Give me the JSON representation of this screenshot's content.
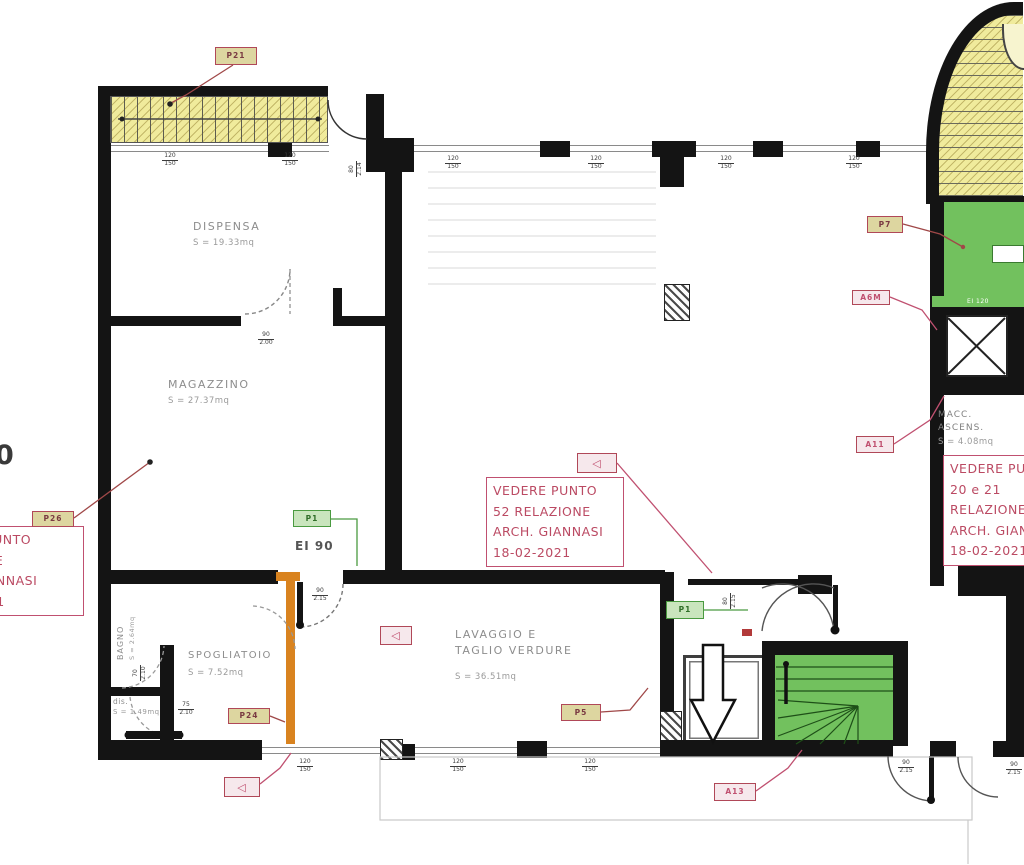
{
  "plan": {
    "rooms": {
      "dispensa": {
        "name": "DISPENSA",
        "area": "S = 19.33mq"
      },
      "magazzino": {
        "name": "MAGAZZINO",
        "area": "S = 27.37mq"
      },
      "bagno": {
        "name": "BAGNO",
        "area": "S = 2.64mq"
      },
      "disimpegno": {
        "name": "dis.",
        "area": "S = 1.49mq"
      },
      "spogliatoio": {
        "name": "SPOGLIATOIO",
        "area": "S = 7.52mq"
      },
      "lavaggio": {
        "name_line1": "LAVAGGIO E",
        "name_line2": "TAGLIO VERDURE",
        "area": "S = 36.51mq"
      },
      "macc": {
        "name_line1": "MACC.",
        "name_line2": "ASCENS.",
        "area": "S = 4.08mq"
      }
    },
    "annotations": {
      "center": {
        "line1": "VEDERE PUNTO",
        "line2": "52 RELAZIONE",
        "line3": "ARCH. GIANNASI",
        "line4": "18-02-2021"
      },
      "right": {
        "line1": "VEDERE PUNTO",
        "line2": "20 e 21",
        "line3": "RELAZIONE",
        "line4": "ARCH. GIANNASI",
        "line5": "18-02-2021"
      },
      "left": {
        "line1": "VEDERE PUNTO",
        "line2": "RELAZIONE",
        "line3": "ARCH. GIANNASI",
        "line4": "18-02-2021"
      }
    },
    "tags": {
      "p21": "P21",
      "p26": "P26",
      "p24": "P24",
      "p5": "P5",
      "p7": "P7",
      "p1_door": "P1",
      "p1_shaft": "P1",
      "a6m": "A6M",
      "a11": "A11",
      "a13": "A13",
      "arrow": "◁"
    },
    "door_rating": "EI 90",
    "shaft_rating": "EI 120",
    "edge_fragment": "0",
    "dims": {
      "win": {
        "w": "120",
        "h": "150"
      },
      "door80": {
        "w": "80",
        "h": "2.14"
      },
      "door90a": {
        "w": "90",
        "h": "2.00"
      },
      "door90b": {
        "w": "90",
        "h": "2.15"
      },
      "door70": {
        "w": "70",
        "h": "2.10"
      },
      "door75": {
        "w": "75",
        "h": "2.10"
      },
      "door80b": {
        "w": "80",
        "h": "2.15"
      }
    },
    "colors": {
      "wall": "#141414",
      "stair_yellow": "#f0eb9c",
      "stair_green": "#72c15e",
      "wall_orange": "#d9831f",
      "annotation_red": "#c05070",
      "tag_tan": "#ddd6a0",
      "tag_green": "#c9e5bd"
    }
  }
}
